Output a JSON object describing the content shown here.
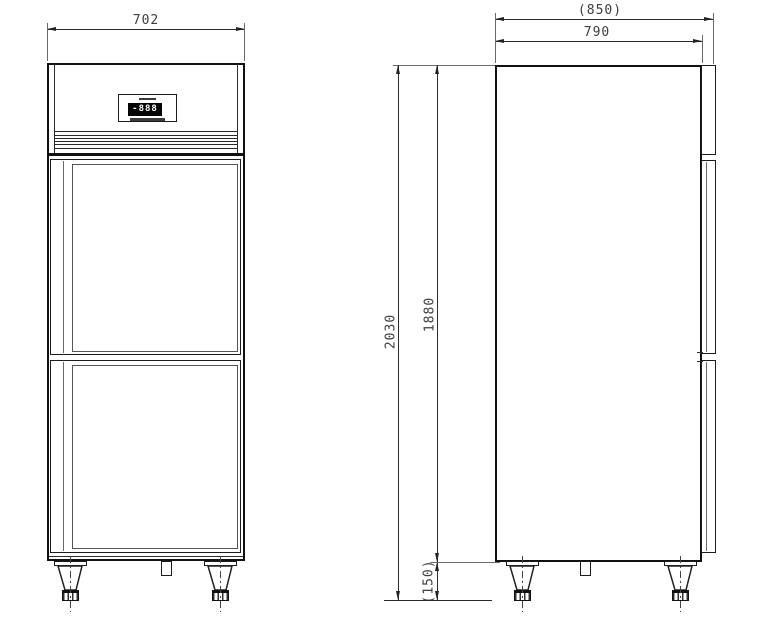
{
  "drawing": {
    "front_view": {
      "width_dim": "702",
      "controller": {
        "display_value": "-888"
      }
    },
    "side_view": {
      "depth_overall_dim": "(850)",
      "depth_body_dim": "790",
      "height_overall_dim": "2030",
      "height_body_dim": "1880",
      "leg_height_dim": "(150)"
    },
    "colors": {
      "line": "#1a1a1a",
      "dim_text": "#3d3d3d",
      "lcd_bg": "#050505",
      "lcd_text": "#ffffff"
    }
  }
}
